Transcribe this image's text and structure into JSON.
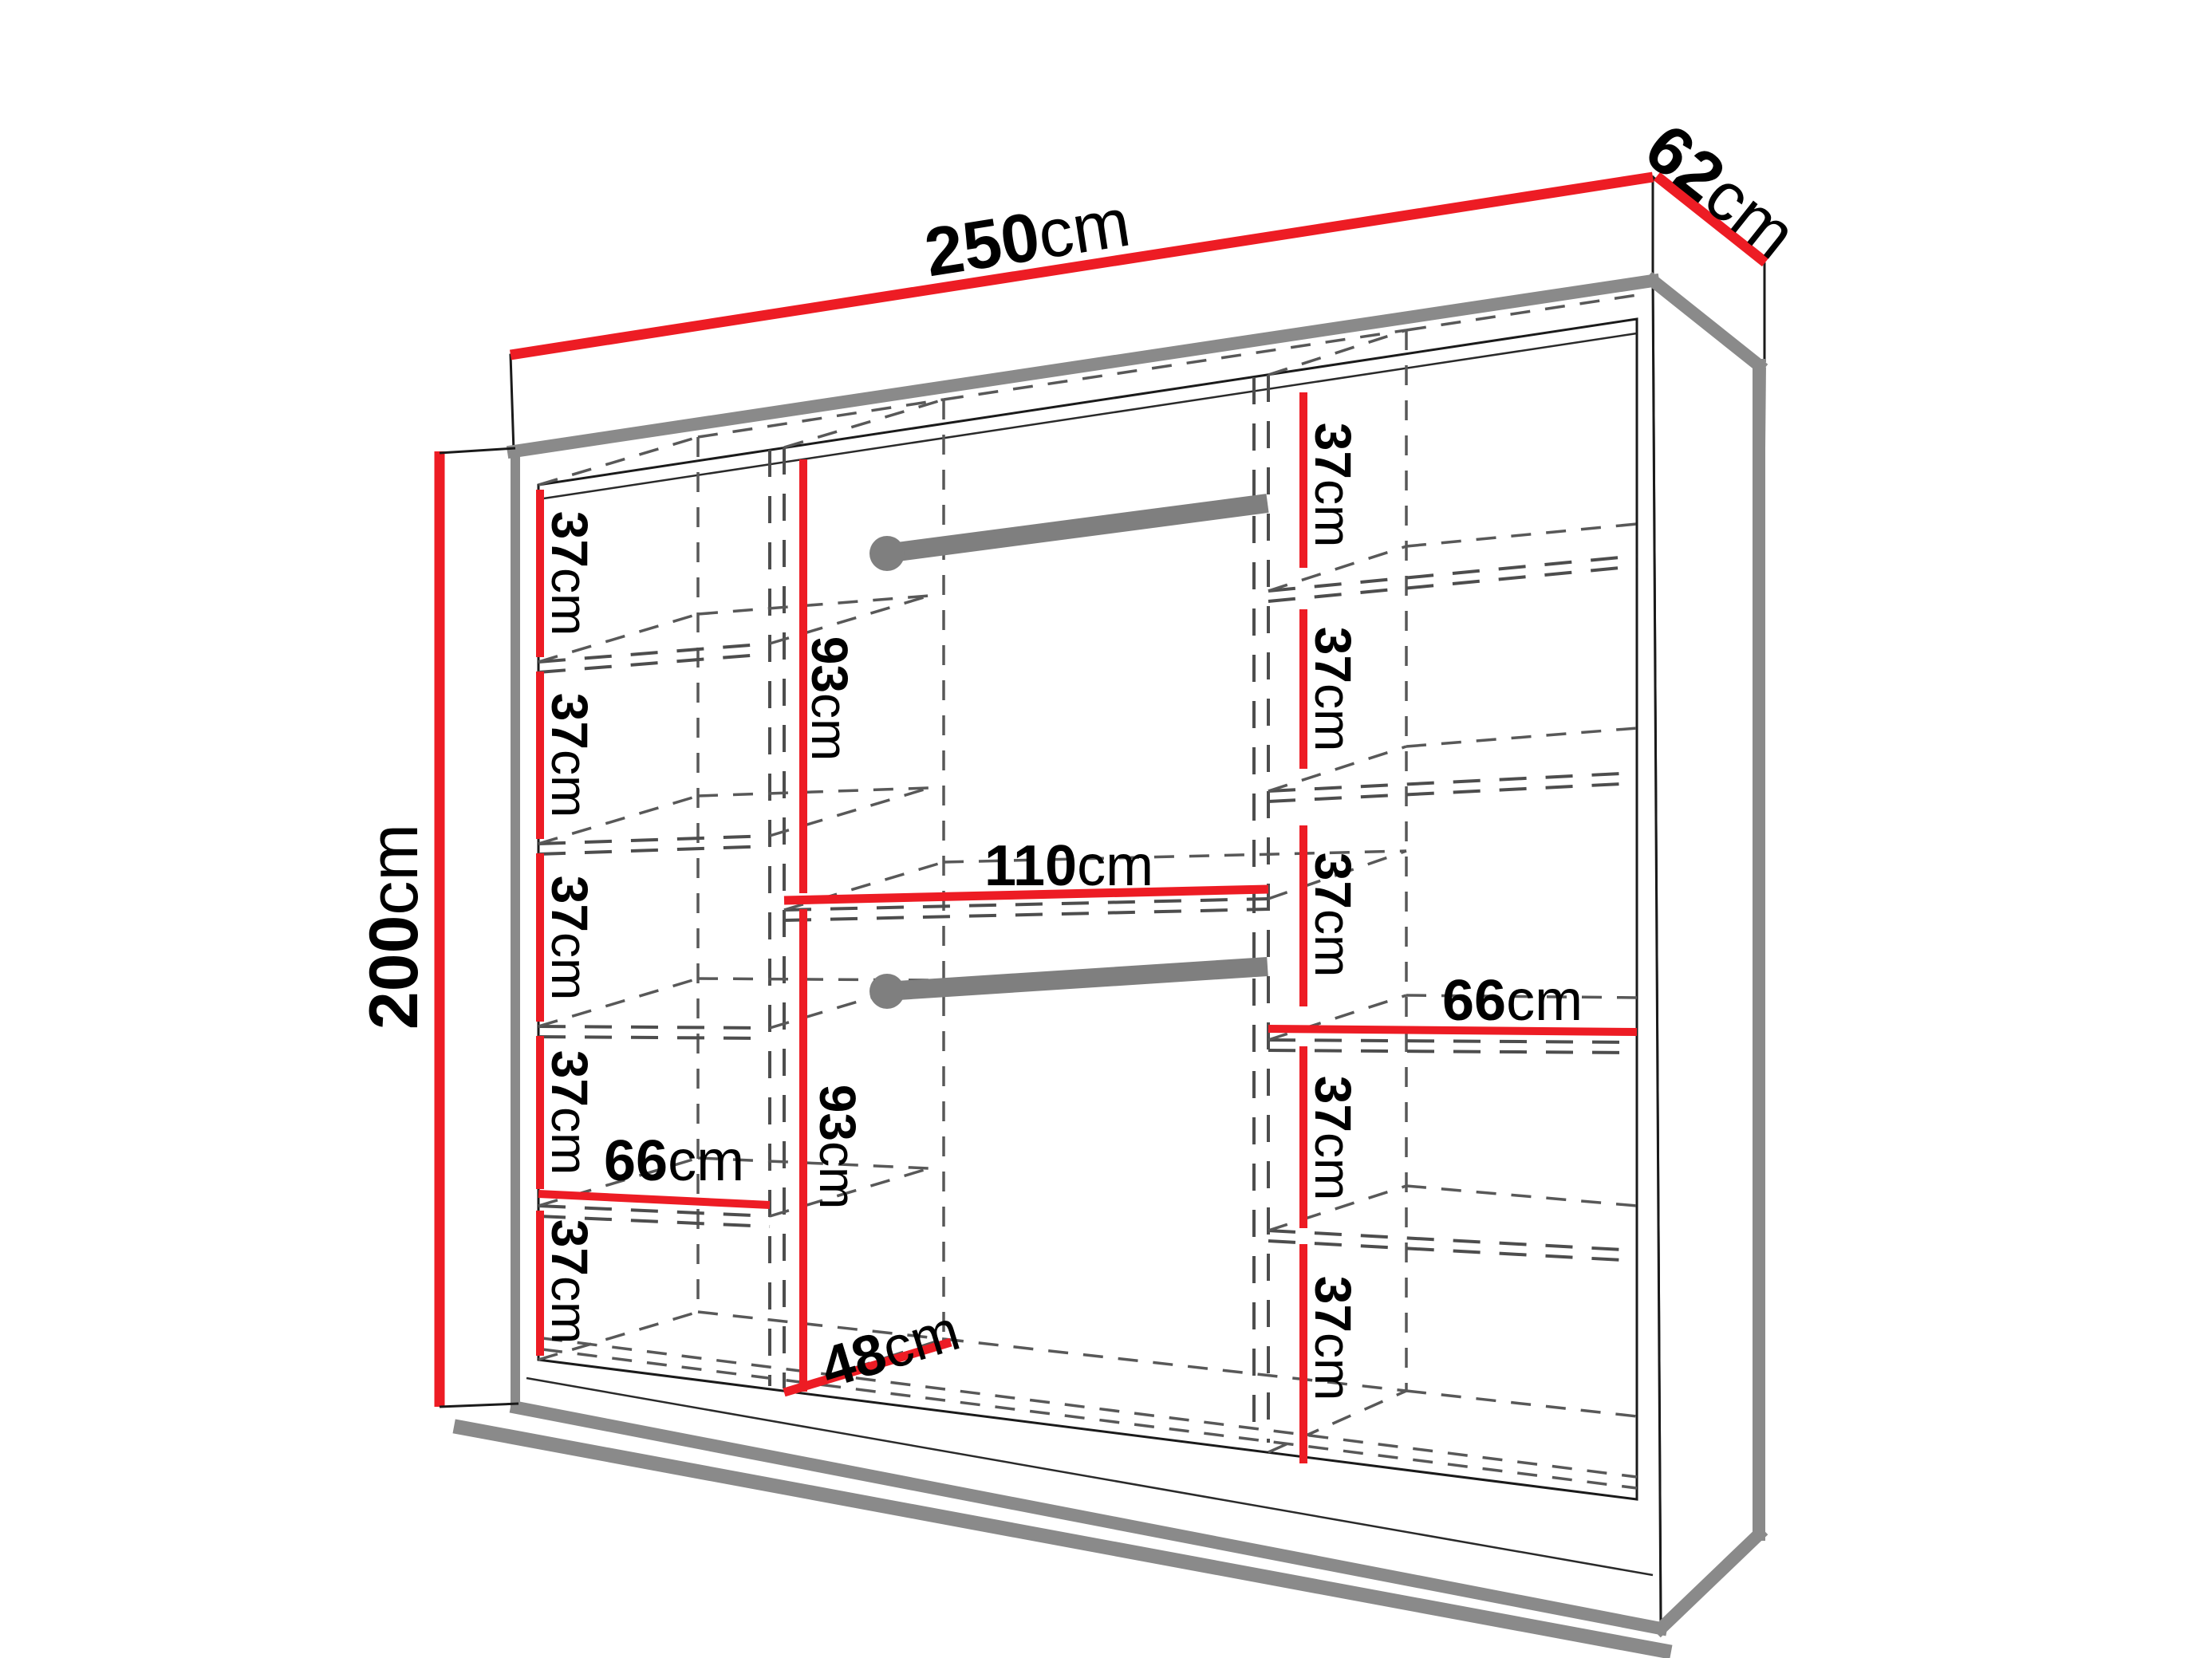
{
  "diagram": {
    "type": "wardrobe-dimension-diagram",
    "overall": {
      "width": {
        "value": "250",
        "unit": "cm"
      },
      "depth": {
        "value": "62",
        "unit": "cm"
      },
      "height": {
        "value": "200",
        "unit": "cm"
      }
    },
    "left_column": {
      "gaps": [
        {
          "value": "37",
          "unit": "cm"
        },
        {
          "value": "37",
          "unit": "cm"
        },
        {
          "value": "37",
          "unit": "cm"
        },
        {
          "value": "37",
          "unit": "cm"
        },
        {
          "value": "37",
          "unit": "cm"
        }
      ],
      "shelf_width": {
        "value": "66",
        "unit": "cm"
      }
    },
    "middle_column": {
      "upper_section_height": {
        "value": "93",
        "unit": "cm"
      },
      "lower_section_height": {
        "value": "93",
        "unit": "cm"
      },
      "width": {
        "value": "110",
        "unit": "cm"
      },
      "usable_depth": {
        "value": "48",
        "unit": "cm"
      }
    },
    "right_column": {
      "gaps": [
        {
          "value": "37",
          "unit": "cm"
        },
        {
          "value": "37",
          "unit": "cm"
        },
        {
          "value": "37",
          "unit": "cm"
        },
        {
          "value": "37",
          "unit": "cm"
        },
        {
          "value": "37",
          "unit": "cm"
        }
      ],
      "shelf_width": {
        "value": "66",
        "unit": "cm"
      }
    },
    "colors": {
      "dimension_red": "#ed1c24",
      "structure_gray": "#8a8a8a",
      "dashed_gray": "#4d4d4d",
      "outline_black": "#1a1a1a"
    }
  }
}
